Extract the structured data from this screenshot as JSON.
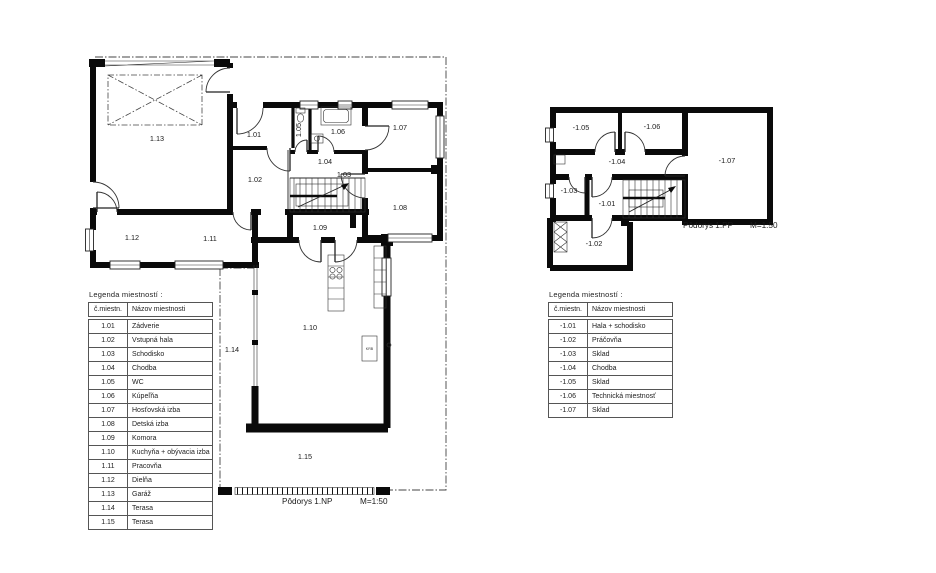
{
  "np": {
    "caption": "Pôdorys 1.NP",
    "scale": "M=1:50",
    "fireplace": "KRB",
    "labels": {
      "r101": "1.01",
      "r102": "1.02",
      "r103": "1.03",
      "r104": "1.04",
      "r105": "1.05",
      "r106": "1.06",
      "r107": "1.07",
      "r108": "1.08",
      "r109": "1.09",
      "r110": "1.10",
      "r111": "1.11",
      "r112": "1.12",
      "r113": "1.13",
      "r114": "1.14",
      "r115": "1.15"
    }
  },
  "pp": {
    "caption": "Pôdorys 1.PP",
    "scale": "M=1:50",
    "labels": {
      "r101": "-1.01",
      "r102": "-1.02",
      "r103": "-1.03",
      "r104": "-1.04",
      "r105": "-1.05",
      "r106": "-1.06",
      "r107": "-1.07"
    }
  },
  "legend_np": {
    "title": "Legenda miestností :",
    "col_no": "č.miestn.",
    "col_name": "Názov miestnosti",
    "rows": [
      {
        "no": "1.01",
        "name": "Zádverie"
      },
      {
        "no": "1.02",
        "name": "Vstupná hala"
      },
      {
        "no": "1.03",
        "name": "Schodisko"
      },
      {
        "no": "1.04",
        "name": "Chodba"
      },
      {
        "no": "1.05",
        "name": "WC"
      },
      {
        "no": "1.06",
        "name": "Kúpeľňa"
      },
      {
        "no": "1.07",
        "name": "Hosťovská izba"
      },
      {
        "no": "1.08",
        "name": "Detská izba"
      },
      {
        "no": "1.09",
        "name": "Komora"
      },
      {
        "no": "1.10",
        "name": "Kuchyňa + obývacia izba"
      },
      {
        "no": "1.11",
        "name": "Pracovňa"
      },
      {
        "no": "1.12",
        "name": "Dielňa"
      },
      {
        "no": "1.13",
        "name": "Garáž"
      },
      {
        "no": "1.14",
        "name": "Terasa"
      },
      {
        "no": "1.15",
        "name": "Terasa"
      }
    ]
  },
  "legend_pp": {
    "title": "Legenda miestností :",
    "col_no": "č.miestn.",
    "col_name": "Názov miestnosti",
    "rows": [
      {
        "no": "-1.01",
        "name": "Hala + schodisko"
      },
      {
        "no": "-1.02",
        "name": "Práčovňa"
      },
      {
        "no": "-1.03",
        "name": "Sklad"
      },
      {
        "no": "-1.04",
        "name": "Chodba"
      },
      {
        "no": "-1.05",
        "name": "Sklad"
      },
      {
        "no": "-1.06",
        "name": "Technická miestnosť"
      },
      {
        "no": "-1.07",
        "name": "Sklad"
      }
    ]
  }
}
